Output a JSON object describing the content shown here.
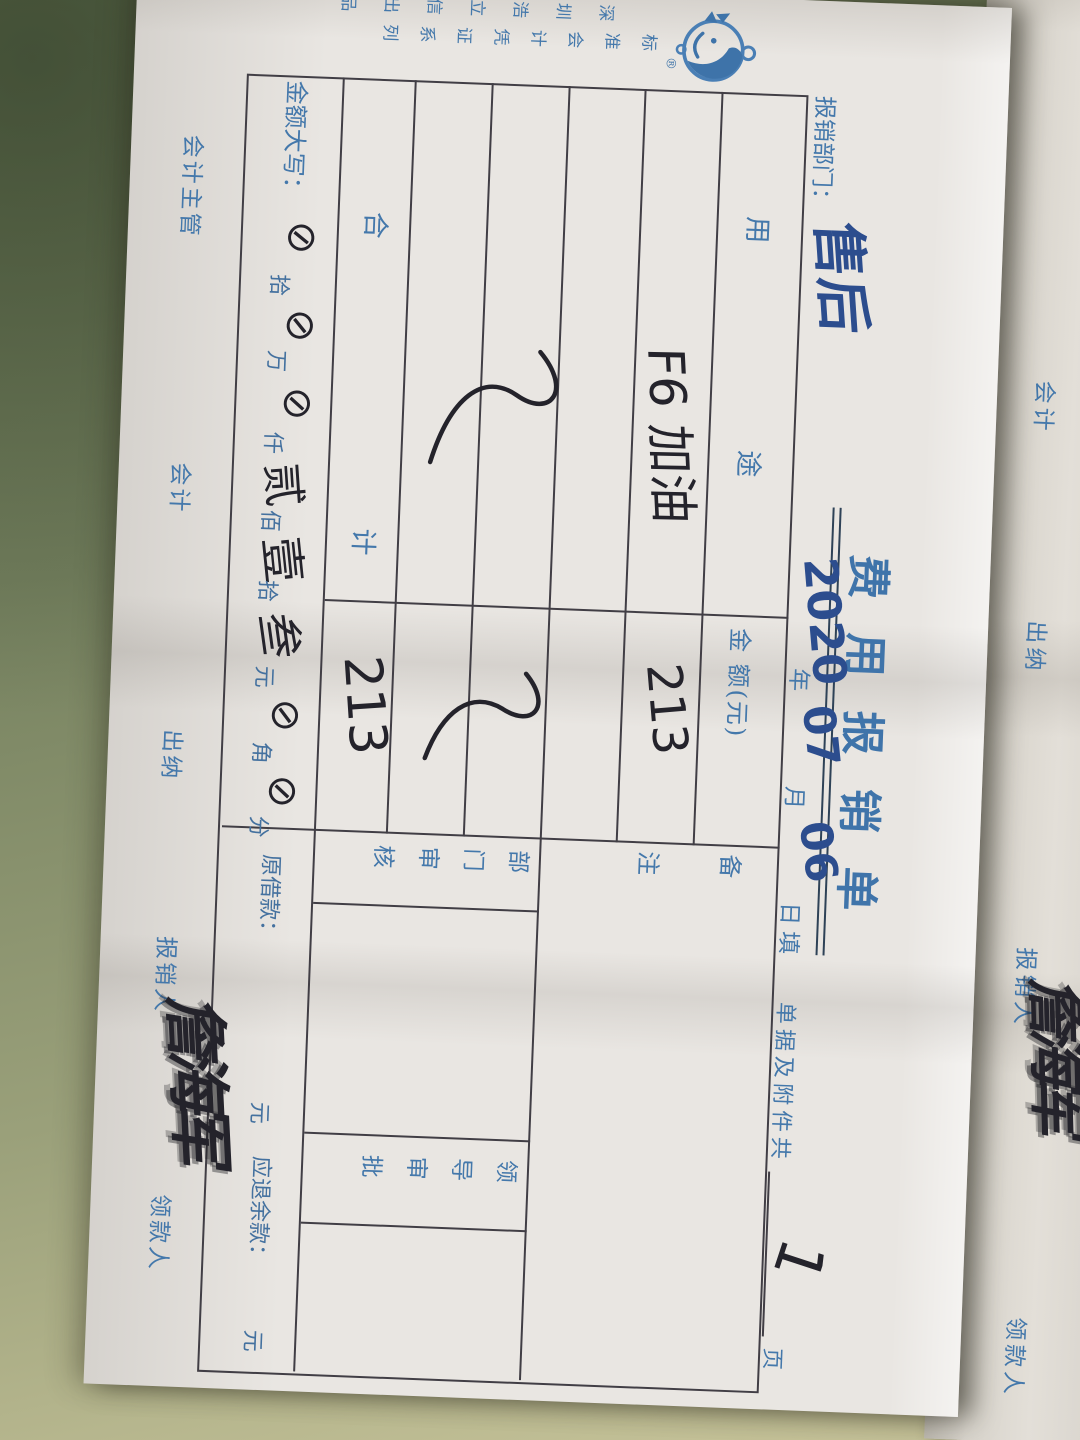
{
  "form": {
    "title": "费用报销单",
    "dept_label": "报销部门：",
    "dept_value": "售后",
    "date": {
      "year": "2020",
      "year_unit": "年",
      "month": "07",
      "month_unit": "月",
      "day": "06",
      "day_unit": "日填"
    },
    "attach": {
      "label": "单据及附件共",
      "pages": "1",
      "unit": "页"
    },
    "table": {
      "col_purpose": [
        "用",
        "途"
      ],
      "col_amount": "金 额(元)",
      "col_remark": "备注",
      "row1_purpose": "F6 加油",
      "row1_amount": "213",
      "total_label": [
        "合",
        "计"
      ],
      "total_amount": "213",
      "dept_review": "部门审核",
      "leader_review": "领导审批",
      "amount_words_label": "金额大写：",
      "amount_words": [
        "⊘",
        "拾",
        "⊘",
        "万",
        "⊘",
        "仟",
        "贰",
        "佰",
        "壹",
        "拾",
        "叁",
        "元",
        "⊘",
        "角",
        "⊘",
        "分"
      ],
      "loan_label": "原借款：",
      "loan_unit": "元",
      "refund_label": "应退余款：",
      "refund_unit": "元"
    },
    "signers": [
      "会计主管",
      "会计",
      "出纳",
      "报销人",
      "领款人"
    ],
    "signature": "詹海军",
    "brand": {
      "series": "标准会计凭证系列",
      "producer": "深圳浩立信出品",
      "reg": "®"
    }
  },
  "sheet2": {
    "labels": [
      "会计",
      "出纳",
      "报销人",
      "领款人"
    ],
    "signature": "詹海军"
  },
  "colors": {
    "print_blue": "#4478ab",
    "pen_blue": "#2c4d8e",
    "pen_black": "#24232b",
    "table_line": "#413e45",
    "desk_green": "#75815f"
  }
}
